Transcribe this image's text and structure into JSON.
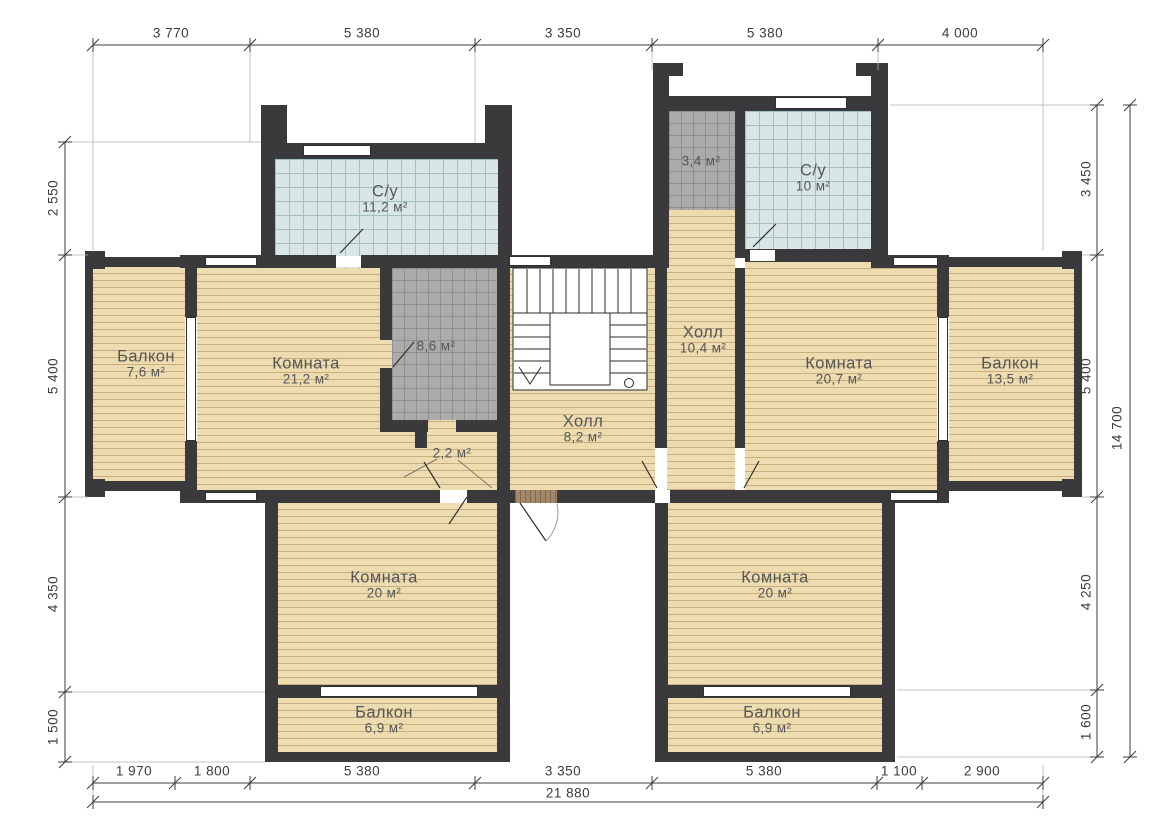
{
  "plan_type": "floor-plan",
  "rooms": {
    "bath_left": {
      "label": "С/у",
      "area": "11,2 м²"
    },
    "utility_top": {
      "area": "3,4 м²"
    },
    "bath_right": {
      "label": "С/у",
      "area": "10 м²"
    },
    "balcony_left": {
      "label": "Балкон",
      "area": "7,6 м²"
    },
    "room_left": {
      "label": "Комната",
      "area": "21,2 м²"
    },
    "dressing": {
      "area": "8,6 м²"
    },
    "hall_upper": {
      "label": "Холл",
      "area": "10,4 м²"
    },
    "hall_center": {
      "label": "Холл",
      "area": "8,2 м²"
    },
    "vestibule": {
      "area": "2,2 м²"
    },
    "room_right": {
      "label": "Комната",
      "area": "20,7 м²"
    },
    "balcony_right": {
      "label": "Балкон",
      "area": "13,5 м²"
    },
    "room_bottom_left": {
      "label": "Комната",
      "area": "20 м²"
    },
    "room_bottom_right": {
      "label": "Комната",
      "area": "20 м²"
    },
    "balcony_bottom_left": {
      "label": "Балкон",
      "area": "6,9 м²"
    },
    "balcony_bottom_right": {
      "label": "Балкон",
      "area": "6,9 м²"
    }
  },
  "dimensions": {
    "top": [
      "3 770",
      "5 380",
      "3 350",
      "5 380",
      "4 000"
    ],
    "bottom": [
      "1 970",
      "1 800",
      "5 380",
      "3 350",
      "5 380",
      "1 100",
      "2 900"
    ],
    "bottom_total": "21 880",
    "left": [
      "2 550",
      "5 400",
      "4 350",
      "1 500"
    ],
    "right": [
      "3 450",
      "5 400",
      "4 250",
      "1 600"
    ],
    "right_total": "14 700"
  },
  "colors": {
    "wall": "#3a3a3c",
    "wood_floor": "#eedcb1",
    "wood_line": "#c9ae80",
    "bath_tile": "#d9e6e6",
    "utility_tile": "#ababab",
    "threshold": "#a3876a"
  }
}
